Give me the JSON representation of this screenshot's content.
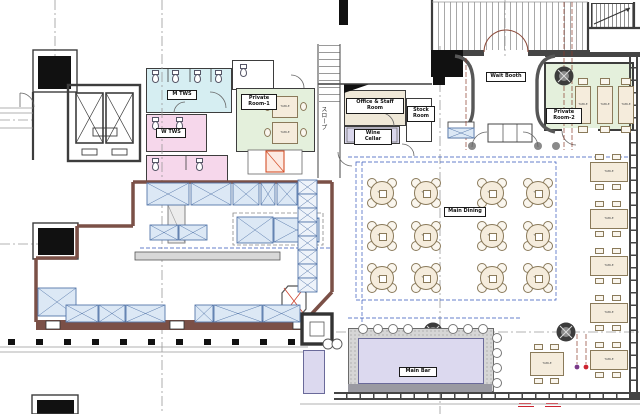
{
  "drawing": {
    "kind": "restaurant floor plan"
  },
  "rooms": {
    "m_tws": "M TWS",
    "w_tws": "W TWS",
    "private_room_1": "Private\nRoom-1",
    "private_room_2": "Private\nRoom-2",
    "office_staff": "Office & Staff Room",
    "wine_cellar": "Wine Cellar",
    "stock_room": "Stock\nRoom",
    "wait_booth": "Wait Booth",
    "main_dining": "Main Dining",
    "main_bar": "Main Bar",
    "ramp": "スロープ"
  },
  "tables": {
    "generic_label": "TABLE"
  },
  "colors": {
    "room_men_ws": "#d6eef2",
    "room_women_ws": "#f6d7eb",
    "private_room": "#e4f0dc",
    "office": "#efe8d8",
    "wine_cellar": "#d9d6ec",
    "bar_floor": "#dcd9ef",
    "equipment": "#dce8f5",
    "table": "#f5ecdc",
    "kitchen_wall": "#7b5047",
    "accent_red": "#cc2430",
    "accent_blue": "#3355bb",
    "accent_purple": "#7a3a8a"
  }
}
